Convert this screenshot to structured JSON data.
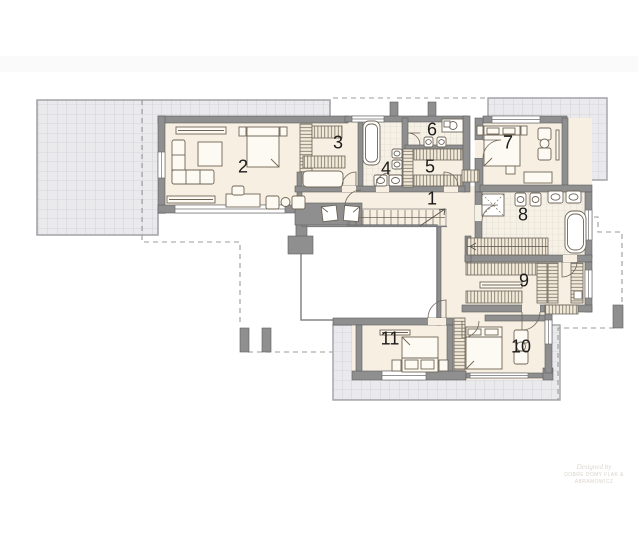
{
  "plan": {
    "kind": "architectural floor plan, upper storey",
    "room_count": 11
  },
  "rooms": [
    {
      "number": "1"
    },
    {
      "number": "2"
    },
    {
      "number": "3"
    },
    {
      "number": "4"
    },
    {
      "number": "5"
    },
    {
      "number": "6"
    },
    {
      "number": "7"
    },
    {
      "number": "8"
    },
    {
      "number": "9"
    },
    {
      "number": "10"
    },
    {
      "number": "11"
    }
  ],
  "watermark": {
    "line1": "Designed by",
    "line2": "DOBRE DOMY FLAK & ABRAMOWICZ"
  },
  "colors": {
    "wall": "#8f8f90",
    "wall_edge": "#5e5e60",
    "floor": "#f7efe2",
    "terrace": "#eaeaed",
    "terrace_grid": "#cdced3",
    "bath_tile": "#f6f1e7",
    "bath_tile_grid": "#ded5c4",
    "hatch_fill": "#f3ead9",
    "furniture_line": "#6f6557",
    "dashed_line": "#9b9b9b"
  }
}
